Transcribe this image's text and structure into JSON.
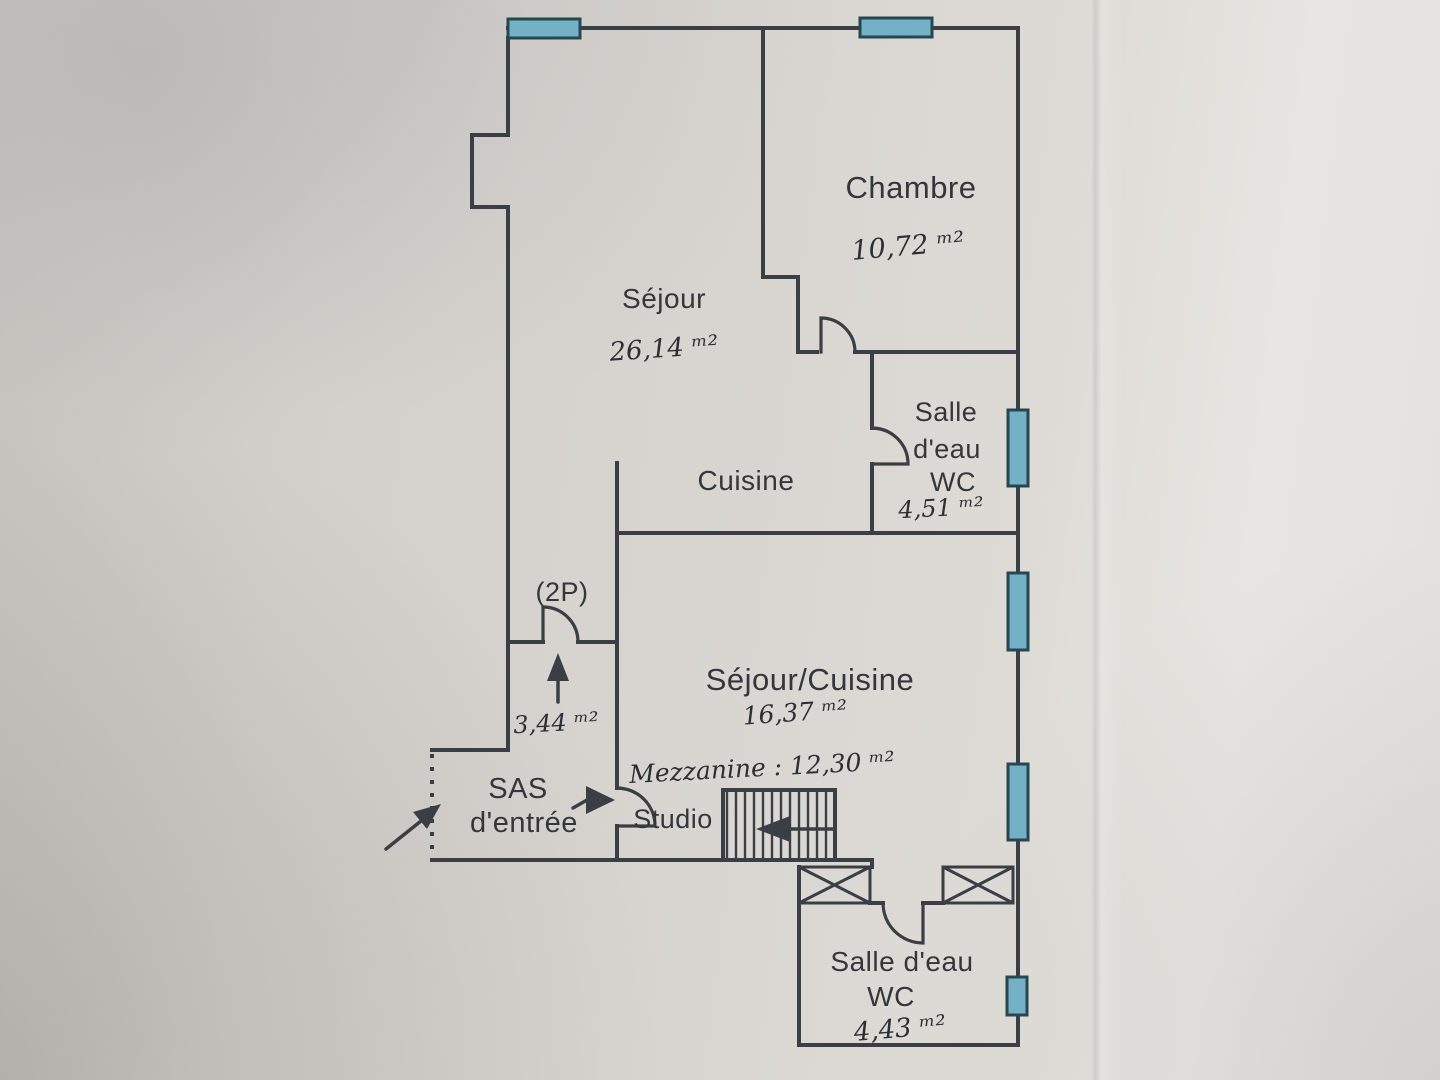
{
  "plan": {
    "rooms": {
      "chambre": {
        "name": "Chambre",
        "area": "10,72 ᵐ²"
      },
      "sejour": {
        "name": "Séjour",
        "area": "26,14 ᵐ²"
      },
      "cuisine": {
        "name": "Cuisine"
      },
      "salle_eau_haut": {
        "line1": "Salle",
        "line2": "d'eau",
        "line3": "WC",
        "area": "4,51 ᵐ²"
      },
      "passage_2p": {
        "name": "(2P)",
        "area": "3,44 ᵐ²"
      },
      "sejour_cuisine": {
        "name": "Séjour/Cuisine",
        "area": "16,37 ᵐ²",
        "mezzanine_note": "Mezzanine : 12,30 ᵐ²"
      },
      "sas": {
        "line1": "SAS",
        "line2": "d'entrée"
      },
      "studio": {
        "name": "Studio"
      },
      "salle_eau_bas": {
        "line1": "Salle d'eau",
        "line2": "WC",
        "area": "4,43 ᵐ²"
      }
    },
    "colors": {
      "wall": "#3a3e45",
      "window_fill": "#74b0c6",
      "window_border": "#274750",
      "label_text": "#33373d",
      "handwriting": "#2b2e35"
    }
  }
}
